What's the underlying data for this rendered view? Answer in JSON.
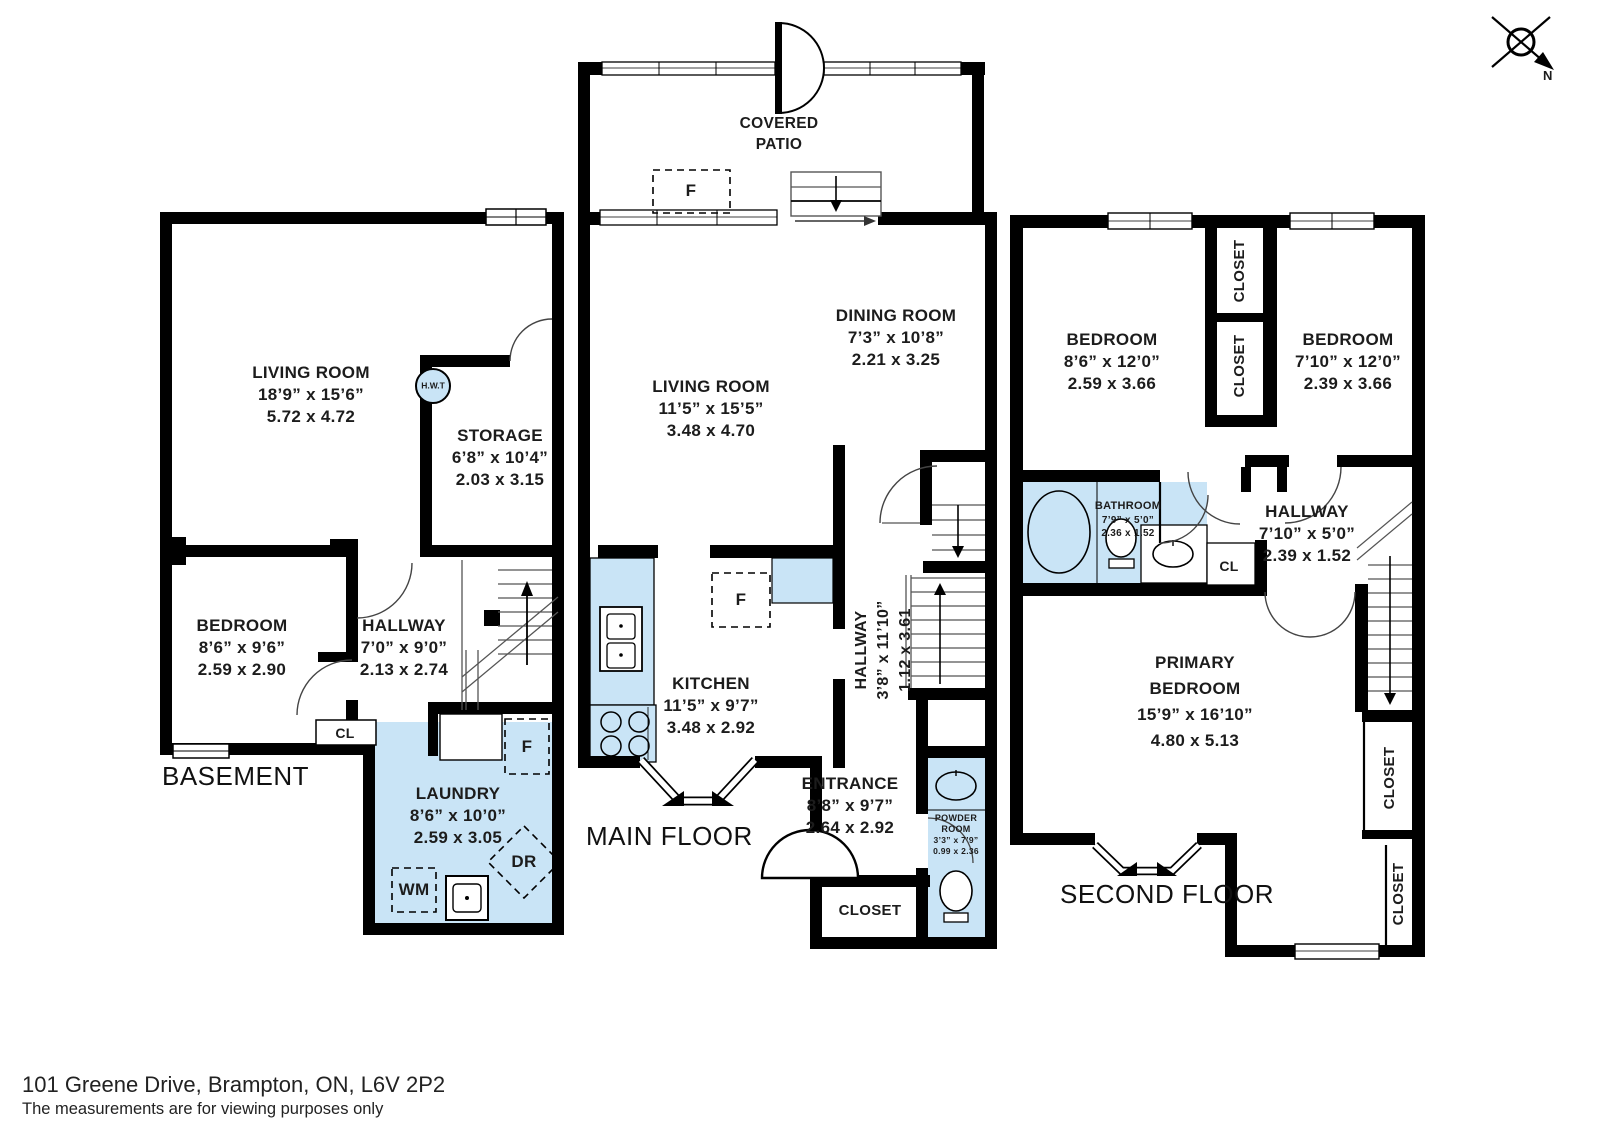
{
  "meta": {
    "address": "101 Greene Drive, Brampton, ON, L6V 2P2",
    "disclaimer": "The measurements are for viewing purposes only"
  },
  "compass": {
    "north_label": "N"
  },
  "basement": {
    "title": "BASEMENT",
    "living_room": {
      "name": "LIVING ROOM",
      "imperial": "18’9” x 15’6”",
      "metric": "5.72 x 4.72"
    },
    "storage": {
      "name": "STORAGE",
      "imperial": "6’8” x 10’4”",
      "metric": "2.03 x 3.15"
    },
    "bedroom": {
      "name": "BEDROOM",
      "imperial": "8’6” x 9’6”",
      "metric": "2.59 x 2.90"
    },
    "hallway": {
      "name": "HALLWAY",
      "imperial": "7’0” x 9’0”",
      "metric": "2.13 x 2.74"
    },
    "laundry": {
      "name": "LAUNDRY",
      "imperial": "8’6” x 10’0”",
      "metric": "2.59 x 3.05"
    },
    "closet": "CL",
    "hot_water_tank": "H.W.T",
    "freezer": "F",
    "washer": "WM",
    "dryer": "DR"
  },
  "main_floor": {
    "title": "MAIN FLOOR",
    "covered_patio": {
      "line1": "COVERED",
      "line2": "PATIO"
    },
    "dining_room": {
      "name": "DINING ROOM",
      "imperial": "7’3” x 10’8”",
      "metric": "2.21 x 3.25"
    },
    "living_room": {
      "name": "LIVING ROOM",
      "imperial": "11’5” x 15’5”",
      "metric": "3.48 x 4.70"
    },
    "kitchen": {
      "name": "KITCHEN",
      "imperial": "11’5” x 9’7”",
      "metric": "3.48 x 2.92"
    },
    "hallway": {
      "name": "HALLWAY",
      "imperial": "3’8” x 11’10”",
      "metric": "1.12 x 3.61"
    },
    "entrance": {
      "name": "ENTRANCE",
      "imperial": "8’8” x 9’7”",
      "metric": "2.64 x 2.92"
    },
    "closet": "CLOSET",
    "powder_room": {
      "line1": "POWDER",
      "line2": "ROOM",
      "imperial": "3’3” x 7’9”",
      "metric": "0.99 x 2.36"
    },
    "fridge": "F",
    "patio_freezer": "F"
  },
  "second_floor": {
    "title": "SECOND FLOOR",
    "bedroom_left": {
      "name": "BEDROOM",
      "imperial": "8’6” x 12’0”",
      "metric": "2.59 x 3.66"
    },
    "bedroom_right": {
      "name": "BEDROOM",
      "imperial": "7’10” x 12’0”",
      "metric": "2.39 x 3.66"
    },
    "bathroom": {
      "name": "BATHROOM",
      "imperial": "7’9” x 5’0”",
      "metric": "2.36 x 1.52"
    },
    "hallway": {
      "name": "HALLWAY",
      "imperial": "7’10” x 5’0”",
      "metric": "2.39 x 1.52"
    },
    "primary_bedroom": {
      "line1": "PRIMARY",
      "line2": "BEDROOM",
      "imperial": "15’9” x 16’10”",
      "metric": "4.80 x 5.13"
    },
    "closet": "CLOSET",
    "cl": "CL"
  },
  "colors": {
    "wall": "#000000",
    "wet_area": "#c9e4f6",
    "thin_line": "#555555"
  }
}
